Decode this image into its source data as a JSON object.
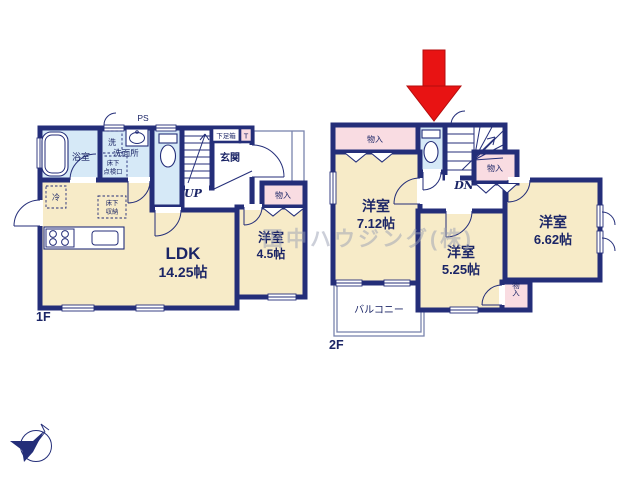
{
  "watermark": "田中ハウジング(株)",
  "colors": {
    "wall": "#242e79",
    "ink": "#1b2566",
    "cream": "#f7ebc8",
    "blue": "#d6e9f7",
    "pink": "#f9dce2",
    "red": "#e81313",
    "thin_line": "#7a84ad",
    "watermark_gray": "#9aa0b4"
  },
  "floor1": {
    "floor_label": "1F",
    "ldk_name": "LDK",
    "ldk_size": "14.25帖",
    "bedroom_name": "洋室",
    "bedroom_size": "4.5帖",
    "bath": "浴室",
    "washroom": "洗面所",
    "washer": "洗",
    "fridge": "冷",
    "entrance": "玄関",
    "shoe_box": "下足箱",
    "toilet_t": "T",
    "ps": "PS",
    "up": "UP",
    "closet": "物入",
    "floor_storage_l1": "床下",
    "floor_storage_l2": "収納",
    "inspection_l1": "床下",
    "inspection_l2": "点検口"
  },
  "floor2": {
    "floor_label": "2F",
    "room712_name": "洋室",
    "room712_size": "7.12帖",
    "room525_name": "洋室",
    "room525_size": "5.25帖",
    "room662_name": "洋室",
    "room662_size": "6.62帖",
    "balcony": "バルコニー",
    "closet_top": "物入",
    "closet_right": "物入",
    "closet_bottom": "物入",
    "dn": "DN"
  }
}
